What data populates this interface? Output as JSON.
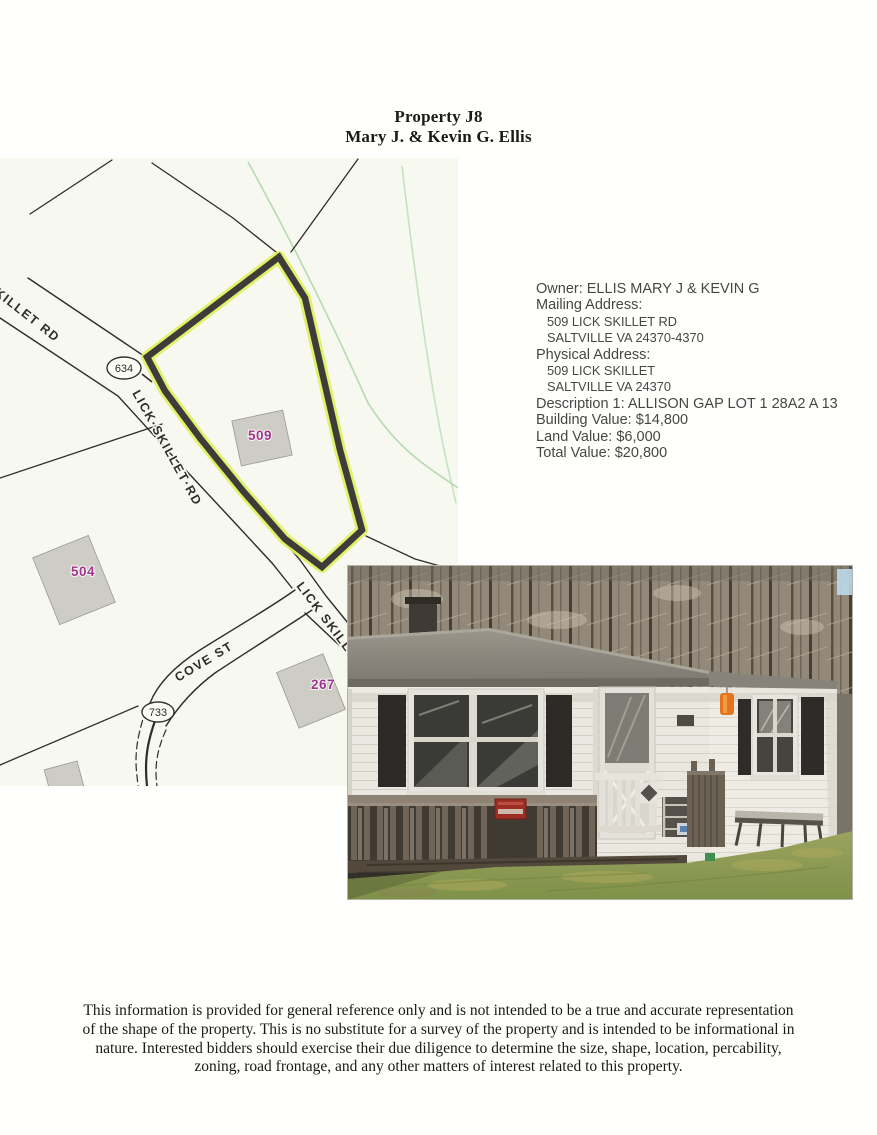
{
  "page": {
    "title_line1": "Property J8",
    "title_line2": "Mary J. & Kevin G. Ellis"
  },
  "property_info": {
    "owner_line": "Owner: ELLIS MARY J & KEVIN G",
    "mailing_label": "Mailing Address:",
    "mailing_line1": "509 LICK SKILLET RD",
    "mailing_line2": "SALTVILLE VA 24370-4370",
    "physical_label": "Physical Address:",
    "physical_line1": "509 LICK SKILLET",
    "physical_line2": "SALTVILLE VA 24370",
    "description_line": "Description 1: ALLISON GAP LOT 1 28A2 A 13",
    "building_value_line": "Building Value: $14,800",
    "land_value_line": "Land Value: $6,000",
    "total_value_line": "Total Value: $20,800"
  },
  "map": {
    "road_labels": {
      "skillet_rd_upper": "SKILLET RD",
      "lick_skillet_rd": "LICK·SKILLET·RD",
      "lick_skillet_partial": "LICK SKILLET RD",
      "cove_st": "COVE ST"
    },
    "route_shields": {
      "route_634": "634",
      "route_733": "733"
    },
    "parcel_labels": {
      "parcel_509": "509",
      "parcel_504": "504",
      "parcel_267": "267"
    },
    "colors": {
      "map_background": "#f7f8f0",
      "parcel_outline_bold": "#3d3c38",
      "parcel_highlight": "#def05c",
      "parcel_label_magenta": "#a23391",
      "building_fill": "#cdcdc6",
      "stream_green": "#aed7a8"
    }
  },
  "photo": {
    "description": "front view of one-story white house with dark shutters, gray roof, wooden porch and lawn"
  },
  "disclaimer": {
    "line1": "This information is provided for general reference only and is not intended to be a true and accurate representation",
    "line2": "of the shape of the property. This is no substitute for a survey of the property and is intended to be informational in",
    "line3": "nature. Interested bidders should exercise their due diligence to determine the size, shape, location, percability,",
    "line4": "zoning, road frontage, and any other matters of interest related to this property."
  }
}
